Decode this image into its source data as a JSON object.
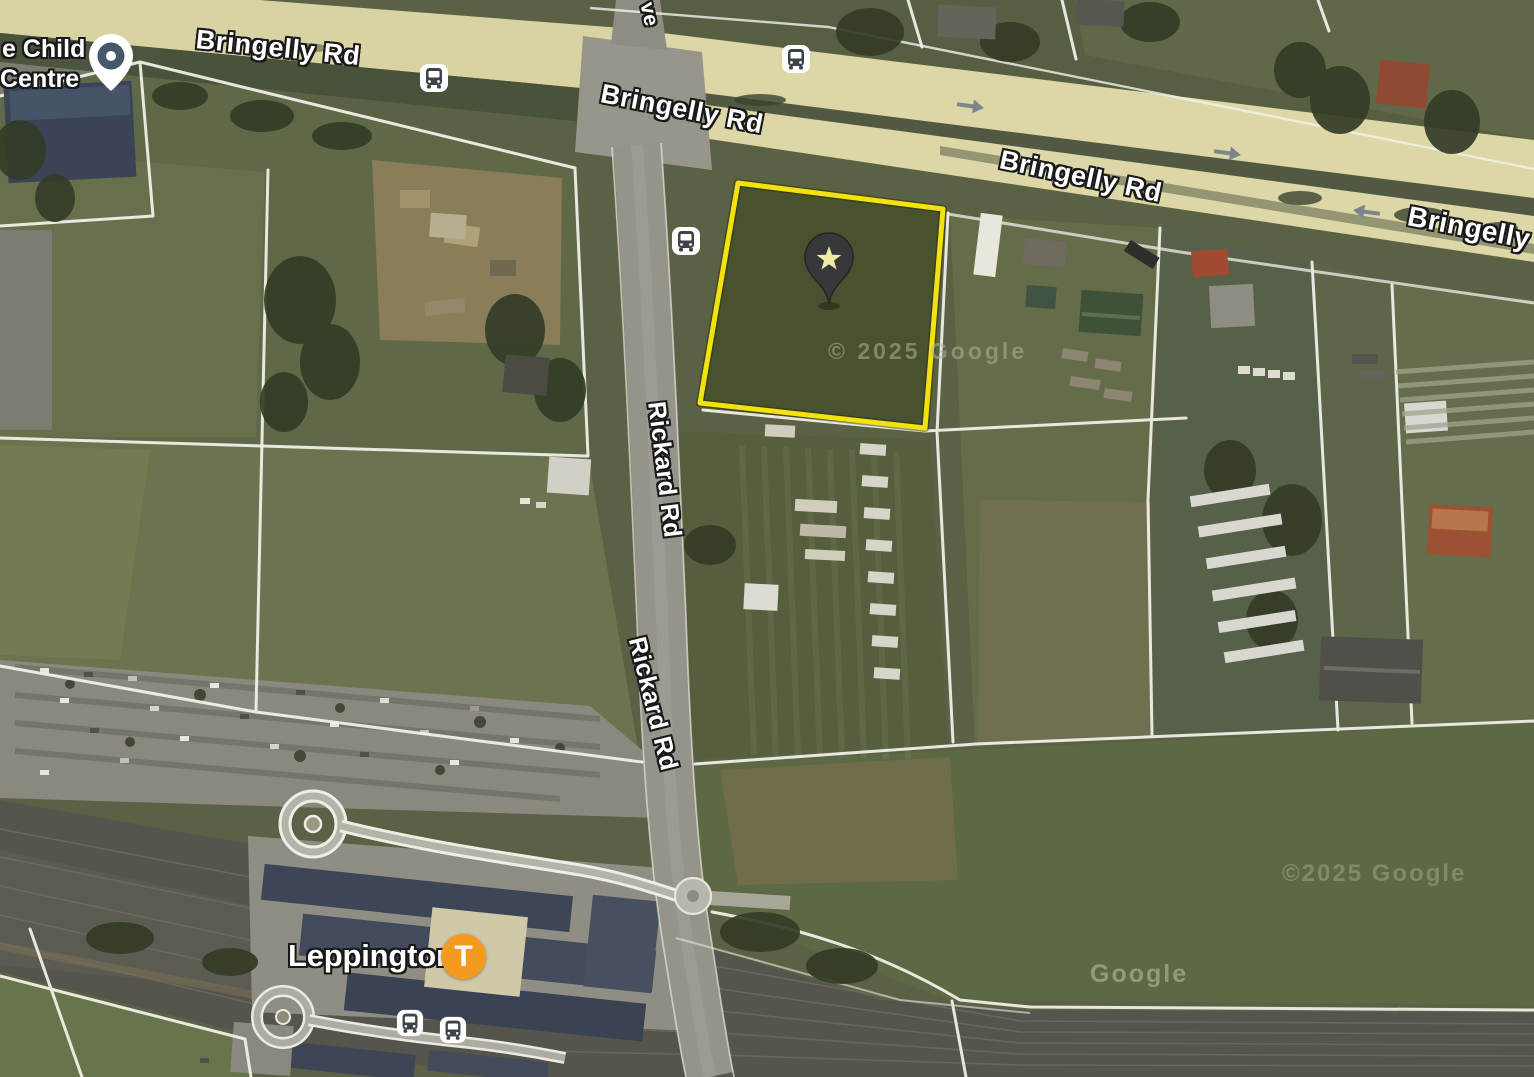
{
  "map": {
    "type": "satellite",
    "road_labels": {
      "bringelly_1": "Bringelly Rd",
      "bringelly_2": "Bringelly Rd",
      "bringelly_3": "Bringelly Rd",
      "bringelly_4": "Bringelly",
      "rickard_1": "Rickard Rd",
      "rickard_2": "Rickard Rd",
      "avenue_partial": "ve"
    },
    "places": {
      "child_centre_line1": "e Child",
      "child_centre_line2": "Centre",
      "leppington": "Leppington",
      "station_badge_letter": "T"
    },
    "watermarks": {
      "parcel": "© 2025 Google",
      "field": "©2025 Google",
      "rail": "Google"
    },
    "icons": {
      "property_marker": "star-pin-icon",
      "place_marker": "location-pin-icon",
      "bus_stop": "bus-icon",
      "train_station": "t-badge-icon",
      "traffic_arrow": "arrow-icon"
    },
    "colors": {
      "parcel_outline": "#f2e20d",
      "road_fill": "#dcd5a5",
      "station_badge": "#f49a1f",
      "boundary_lines": "#f4f3ec",
      "label_text": "#ffffff"
    }
  }
}
